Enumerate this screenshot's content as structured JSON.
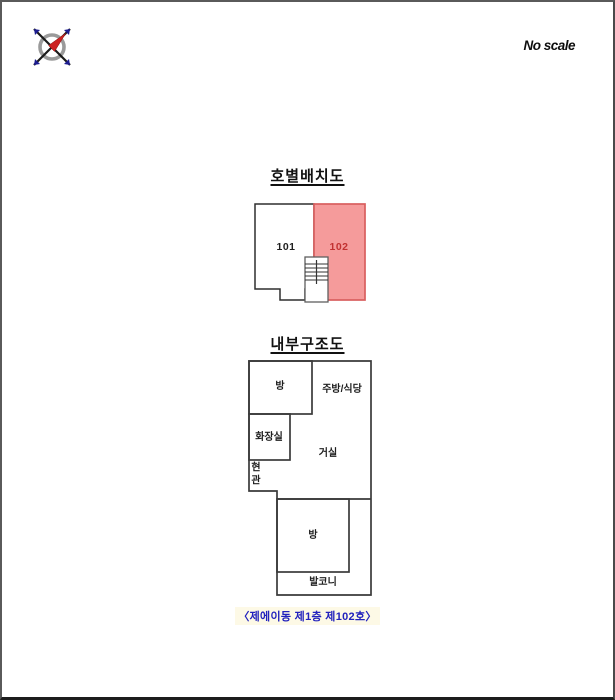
{
  "header": {
    "scale_note": "No scale",
    "compass_icon": "compass-rose"
  },
  "unit_layout": {
    "title": "호별배치도",
    "unit_101": {
      "label": "101"
    },
    "unit_102": {
      "label": "102"
    },
    "colors": {
      "highlight_fill": "#f59b9b",
      "highlight_border": "#d95f5f",
      "highlight_text": "#c23232"
    }
  },
  "internal_structure": {
    "title": "내부구조도",
    "rooms": {
      "room_top": "방",
      "kitchen_dining": "주방/식당",
      "bathroom": "화장실",
      "living_room": "거실",
      "entrance": "현관",
      "room_bottom": "방",
      "balcony": "발코니"
    }
  },
  "footer": {
    "caption": "〈제에이동 제1층 제102호〉"
  }
}
